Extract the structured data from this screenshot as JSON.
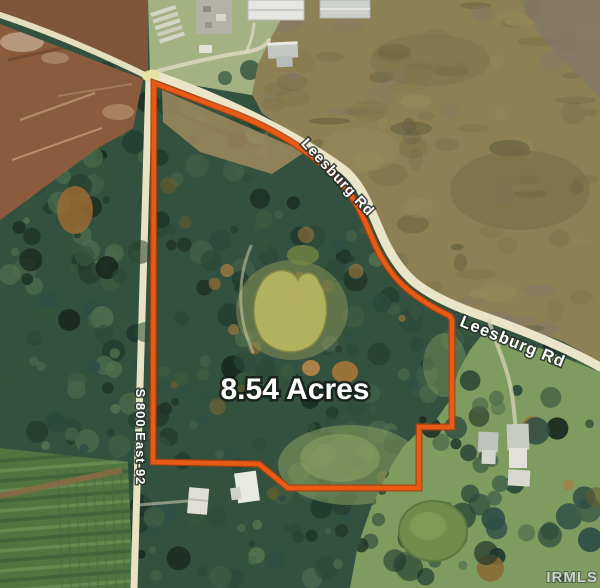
{
  "map": {
    "acreage_label": "8.54 Acres",
    "road_labels": {
      "leesburg_upper": "Leesburg Rd",
      "leesburg_lower": "Leesburg Rd",
      "south_800_east": "S 800 East-92"
    },
    "watermark": "IRMLS",
    "colors": {
      "boundary": "#E85B17",
      "boundary_edge": "#AC3F0C",
      "road": "#E9E3C4",
      "forest_base": "#33513F",
      "field_brown": "#8A5C3D",
      "scrub": "#8D8054",
      "pond": "#B6B660",
      "crop_field": "#517440",
      "lawn": "#7E9C5F"
    }
  }
}
